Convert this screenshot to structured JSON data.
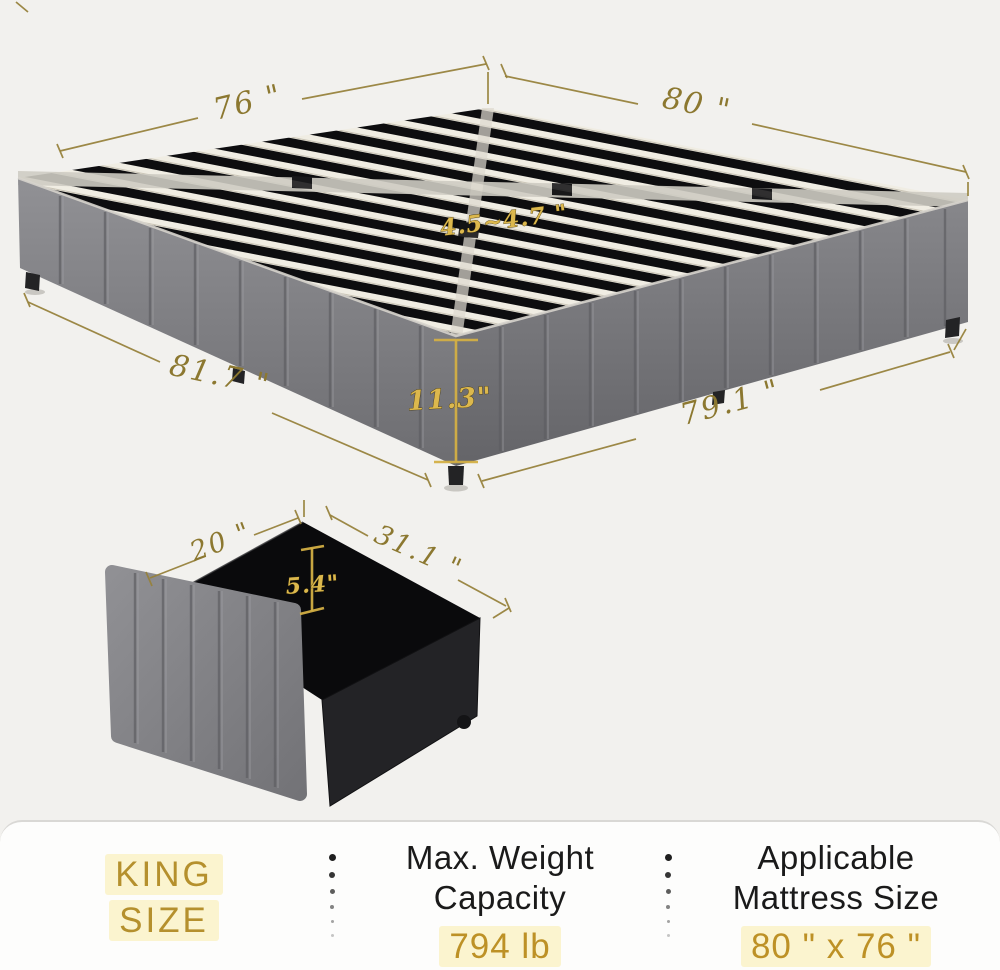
{
  "colors": {
    "dimension_gold": "#8c7830",
    "bright_gold": "#dcb84d",
    "spec_gold": "#b7922f",
    "ink": "#1a1a1a",
    "highlight": "#fbf4cf",
    "upholstery_gray": "#85858a",
    "slat_black": "#0d0d0f"
  },
  "bed_diagram": {
    "width_top": "76 \"",
    "length_top": "80 \"",
    "slat_range": "4.5~4.7 \"",
    "length_bottom_left": "81.7 \"",
    "height": "11.3\"",
    "length_bottom_right": "79.1 \""
  },
  "drawer_diagram": {
    "width": "20 \"",
    "depth": "31.1 \"",
    "height": "5.4\""
  },
  "specs": {
    "size_line1": "KING",
    "size_line2": "SIZE",
    "weight_label_line1": "Max. Weight",
    "weight_label_line2": "Capacity",
    "weight_value": "794 lb",
    "mattress_label_line1": "Applicable",
    "mattress_label_line2": "Mattress Size",
    "mattress_value": "80 \" x 76 \""
  }
}
